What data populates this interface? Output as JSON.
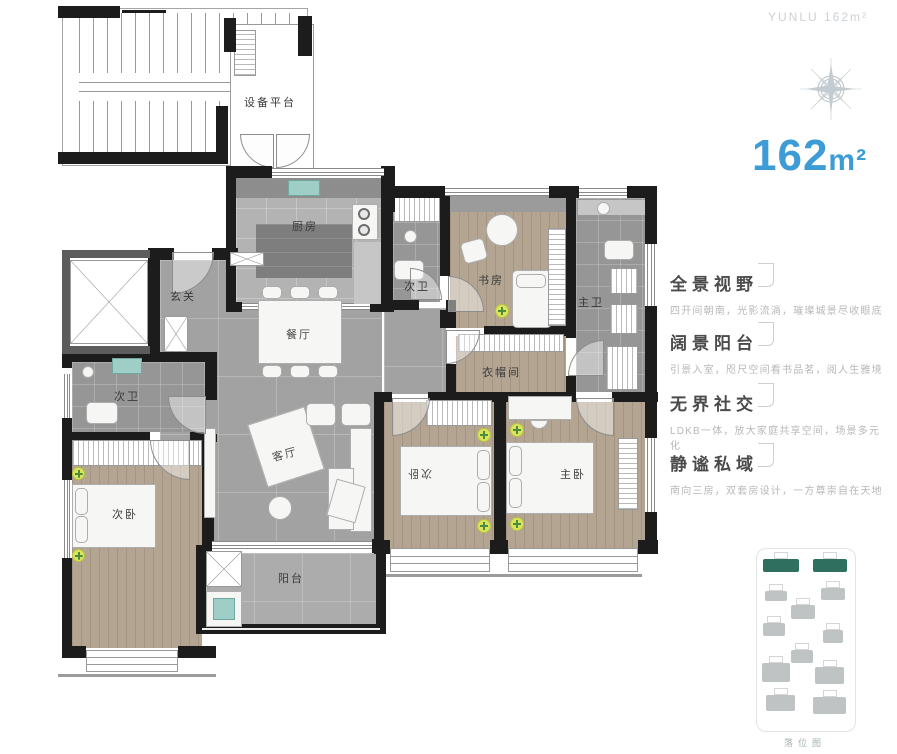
{
  "header": {
    "watermark": "YUNLU 162m²",
    "area_value": "162",
    "area_unit": "m²"
  },
  "plan": {
    "rooms": {
      "equipment": "设备平台",
      "kitchen": "厨房",
      "foyer": "玄关",
      "dining": "餐厅",
      "living": "客厅",
      "balcony": "阳台",
      "bath2_left": "次卫",
      "bath2_mid": "次卫",
      "bath_master": "主卫",
      "study": "书房",
      "closet": "衣帽间",
      "bed2_left": "次卧",
      "bed2_mid": "次卧",
      "bed_master": "主卧"
    }
  },
  "features": [
    {
      "title": "全景视野",
      "desc": "四开间朝南，光影流淌，璀璨城景尽收眼底"
    },
    {
      "title": "阔景阳台",
      "desc": "引景入室，咫尺空间看书品茗，阅人生雅境"
    },
    {
      "title": "无界社交",
      "desc": "LDKB一体，放大家庭共享空间，场景多元化"
    },
    {
      "title": "静谧私域",
      "desc": "南向三房，双套房设计，一方尊崇自在天地"
    }
  ],
  "site_plan": {
    "caption": "落位图",
    "buildings": [
      {
        "x": 6,
        "y": 10,
        "w": 36,
        "h": 13,
        "c": "green"
      },
      {
        "x": 56,
        "y": 10,
        "w": 34,
        "h": 13,
        "c": "green"
      },
      {
        "x": 8,
        "y": 42,
        "w": 22,
        "h": 10,
        "c": "gray"
      },
      {
        "x": 64,
        "y": 39,
        "w": 24,
        "h": 12,
        "c": "gray"
      },
      {
        "x": 34,
        "y": 56,
        "w": 24,
        "h": 14,
        "c": "gray"
      },
      {
        "x": 6,
        "y": 74,
        "w": 22,
        "h": 13,
        "c": "gray"
      },
      {
        "x": 66,
        "y": 81,
        "w": 20,
        "h": 13,
        "c": "gray"
      },
      {
        "x": 34,
        "y": 101,
        "w": 22,
        "h": 13,
        "c": "gray"
      },
      {
        "x": 5,
        "y": 114,
        "w": 28,
        "h": 19,
        "c": "gray"
      },
      {
        "x": 58,
        "y": 118,
        "w": 29,
        "h": 17,
        "c": "gray"
      },
      {
        "x": 9,
        "y": 146,
        "w": 29,
        "h": 16,
        "c": "gray"
      },
      {
        "x": 56,
        "y": 148,
        "w": 33,
        "h": 17,
        "c": "gray"
      }
    ]
  },
  "colors": {
    "accent_blue": "#3d9cd6",
    "site_green": "#2e6f5f",
    "wall_black": "#1c1c1c",
    "sink_teal": "#9ecec5",
    "plant_yellow": "#d9e35c"
  },
  "icons": {
    "compass": "compass-rose-icon",
    "plant": "plant-icon",
    "elevator": "elevator-x-icon",
    "washer": "washing-machine-icon"
  }
}
